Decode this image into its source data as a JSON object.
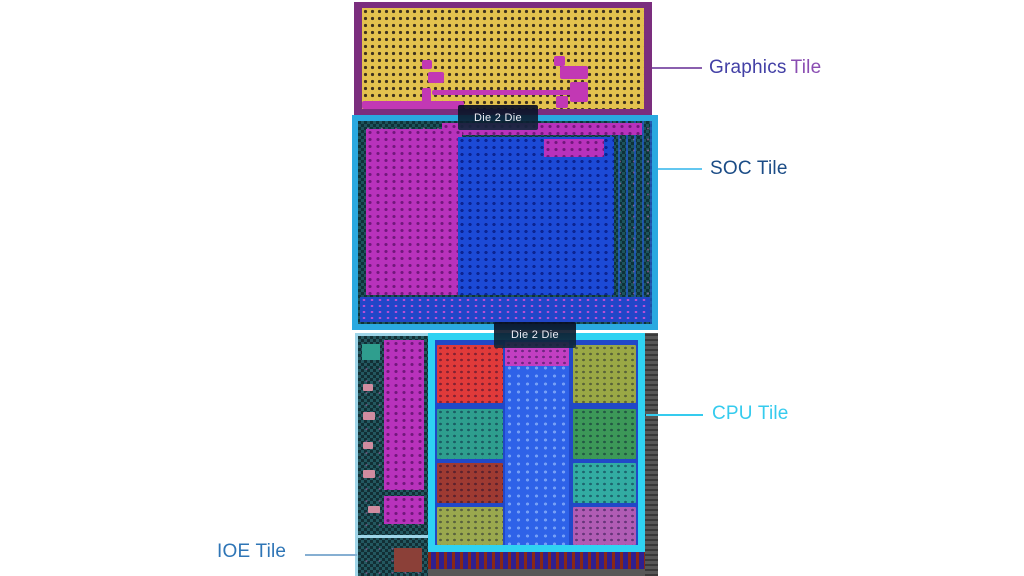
{
  "die_map": {
    "d2d_top": "Die 2 Die",
    "d2d_bottom": "Die 2 Die"
  },
  "callouts": {
    "graphics": {
      "word1": "Graphics",
      "word2": "Tile",
      "color_word1": "#4340A6",
      "color_word2": "#8A4DB2",
      "line_color": "#8A5FAE"
    },
    "soc": {
      "label": "SOC Tile",
      "color": "#1B4C86",
      "line_color": "#63C7F0"
    },
    "cpu": {
      "label": "CPU Tile",
      "color": "#35CBEE",
      "line_color": "#35CBEE"
    },
    "ioe": {
      "label": "IOE Tile",
      "color": "#2E75B6",
      "line_color": "#86AFD2"
    }
  },
  "tiles": {
    "graphics": {
      "border_color": "#7B2E7E",
      "fill": "#E3C24E"
    },
    "soc": {
      "border_color": "#2AA9E0",
      "fill_left_block": "#B832BC",
      "fill_main_block": "#1C4AD6"
    },
    "cpu": {
      "border_color": "#2FD2F2",
      "block_colors": [
        "#E03A3A",
        "#C23FC2",
        "#9AA845",
        "#2E9E8E",
        "#3C9858",
        "#9E3A32",
        "#32ACA2",
        "#9AA84E",
        "#B05CB4"
      ]
    },
    "ioe": {
      "border_color": "#9FD5E8",
      "fill_block": "#B832BC"
    }
  }
}
